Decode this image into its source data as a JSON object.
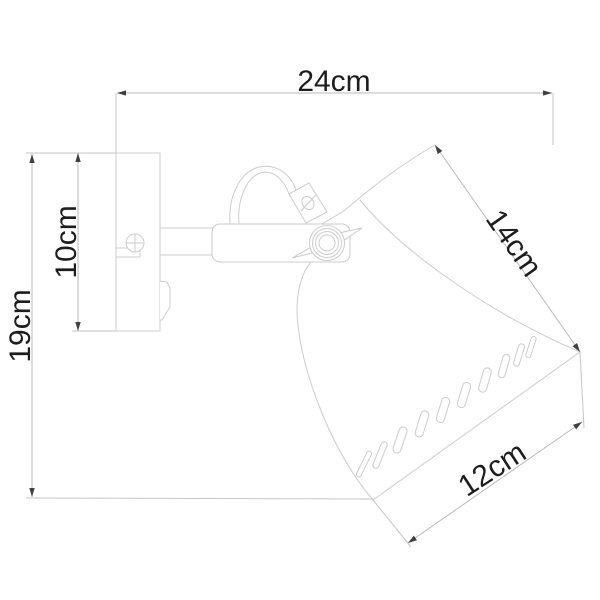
{
  "drawing": {
    "subject": "wall lamp dimension drawing",
    "background": "#ffffff"
  },
  "dimensions": [
    {
      "id": "overall-width",
      "label": "24cm",
      "value": 24,
      "unit": "cm"
    },
    {
      "id": "overall-height",
      "label": "19cm",
      "value": 19,
      "unit": "cm"
    },
    {
      "id": "backplate-height",
      "label": "10cm",
      "value": 10,
      "unit": "cm"
    },
    {
      "id": "shade-slant-length",
      "label": "14cm",
      "value": 14,
      "unit": "cm"
    },
    {
      "id": "shade-opening-width",
      "label": "12cm",
      "value": 12,
      "unit": "cm"
    }
  ],
  "colors": {
    "object_line": "#cccccc",
    "dimension_line": "#b7bbbb",
    "arrowhead": "#404040",
    "label_text": "#1d1d1d"
  }
}
